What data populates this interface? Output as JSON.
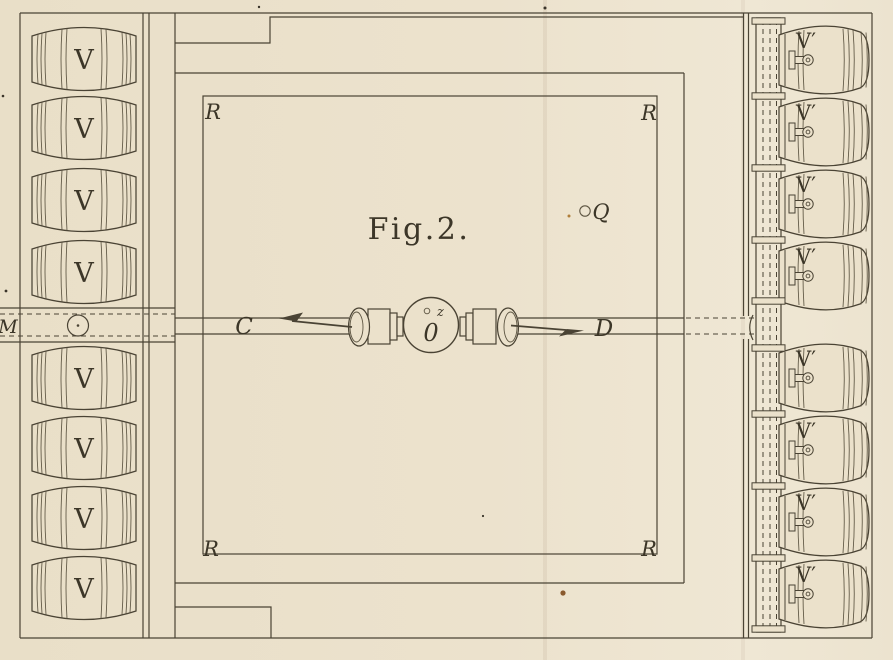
{
  "figure": {
    "title": "Fig.2.",
    "colors": {
      "paper": "#ebe1cb",
      "paper_light": "#f1e9d7",
      "ink": "#4a4334",
      "speck_rust": "#8a5a2e"
    },
    "labels": {
      "figure_title": "Fig.2.",
      "left_vessel": "V",
      "right_vessel": "V′",
      "room_corner": "R",
      "left_pipe": "C",
      "right_pipe": "D",
      "fan": "0",
      "fan_orifice": "z",
      "port": "Q",
      "main_duct": "M"
    },
    "left_rack": {
      "vessel_label": "V",
      "barrel_y_centers": [
        59,
        128,
        200,
        272,
        378,
        448,
        518,
        588
      ]
    },
    "right_rack": {
      "vessel_label": "V′",
      "barrel_y_centers": [
        60,
        132,
        204,
        276,
        378,
        450,
        522,
        594
      ],
      "duct_flange_ys": [
        21,
        96,
        168,
        240,
        301,
        348,
        414,
        486,
        558,
        629
      ]
    },
    "room": {
      "corner_label": "R",
      "corner_positions": [
        [
          213,
          119
        ],
        [
          649,
          120
        ],
        [
          211,
          556
        ],
        [
          649,
          556
        ]
      ]
    },
    "specks": [
      {
        "x": 563,
        "y": 593,
        "r": 2.6,
        "color": "#8a5a2e"
      },
      {
        "x": 569,
        "y": 216,
        "r": 1.5,
        "color": "#b07f3a"
      },
      {
        "x": 545,
        "y": 8,
        "r": 1.5,
        "color": "#3a342a"
      },
      {
        "x": 259,
        "y": 7,
        "r": 1.2,
        "color": "#3a342a"
      },
      {
        "x": 6,
        "y": 291,
        "r": 1.4,
        "color": "#3a342a"
      },
      {
        "x": 3,
        "y": 96,
        "r": 1.3,
        "color": "#3a342a"
      },
      {
        "x": 483,
        "y": 516,
        "r": 1.1,
        "color": "#3a342a"
      }
    ]
  }
}
